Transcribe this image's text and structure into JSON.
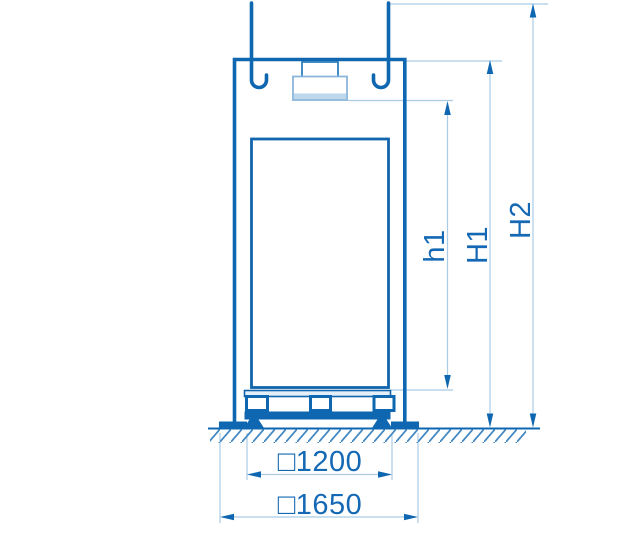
{
  "diagram": {
    "dimension_labels": {
      "h1": "h1",
      "H1": "H1",
      "H2": "H2",
      "base_inner": "□1200",
      "base_outer": "□1650"
    },
    "colors": {
      "outline": "#0e67b0",
      "dimension_line": "#a9cbe5",
      "label_text": "#1569b4",
      "light_fill": "#bdd7ec",
      "hatch": "#4489c2"
    }
  }
}
